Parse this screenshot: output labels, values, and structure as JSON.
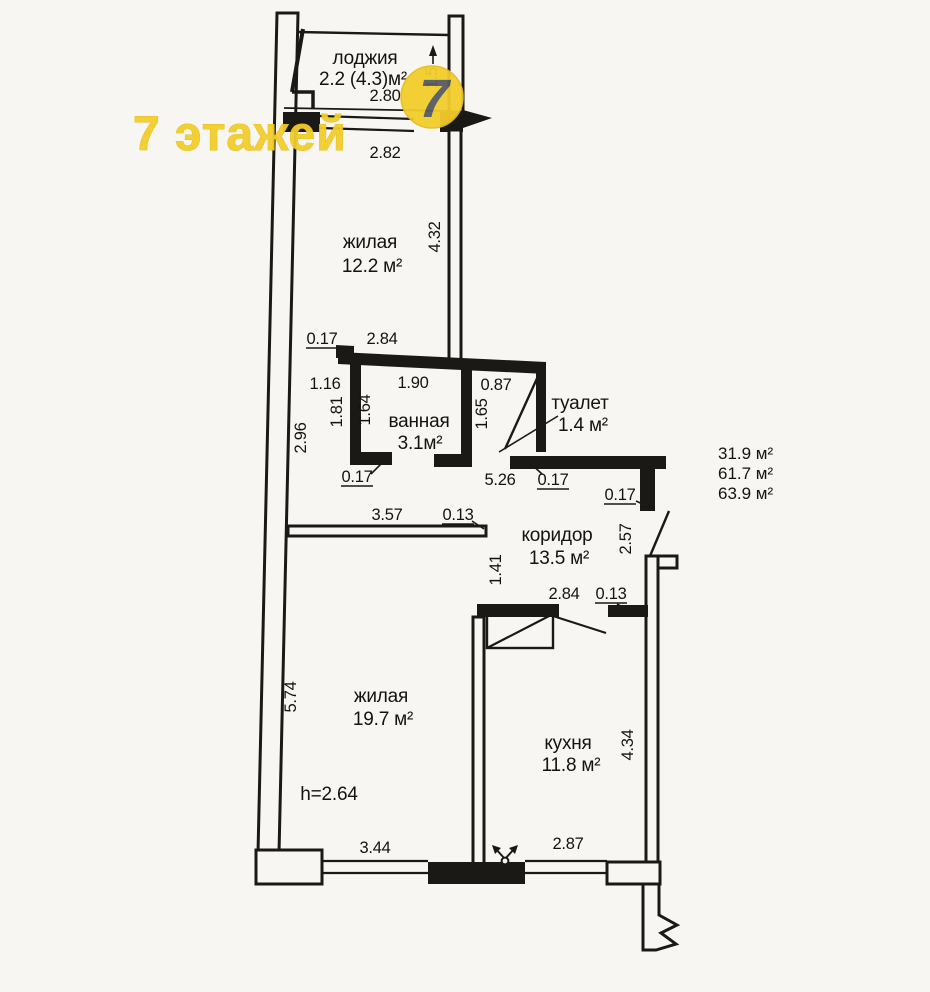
{
  "colors": {
    "paper": "#f8f6f2",
    "ink": "#1b1916",
    "watermark_yellow": "#f2cd2b",
    "logo_digit_gray": "#565b62"
  },
  "watermark": {
    "text": "7 этажей",
    "logo_digit": "7"
  },
  "rooms": {
    "loggia": {
      "name": "лоджия",
      "area": "2.2 (4.3)м²"
    },
    "living1": {
      "name": "жилая",
      "area": "12.2 м²"
    },
    "bathroom": {
      "name": "ванная",
      "area": "3.1м²"
    },
    "toilet": {
      "name": "туалет",
      "area": "1.4 м²"
    },
    "corridor": {
      "name": "коридор",
      "area": "13.5 м²"
    },
    "living2": {
      "name": "жилая",
      "area": "19.7 м²"
    },
    "kitchen": {
      "name": "кухня",
      "area": "11.8 м²"
    }
  },
  "totals": {
    "living_area": "31.9 м²",
    "floor_area": "61.7 м²",
    "total_area": "63.9 м²"
  },
  "ceiling_height": "h=2.64",
  "dims": {
    "loggia_width_top": "2.80",
    "loggia_width_bottom": "2.82",
    "loggia_depth": "1.5",
    "living1_height": "4.32",
    "living1_door_offset": "0.17",
    "living1_width": "2.84",
    "hall_width": "1.16",
    "bath_width": "1.90",
    "wc_width": "0.87",
    "hall_left_height": "1.81",
    "bath_depth": "1.64",
    "wc_depth": "1.65",
    "hall_height": "2.96",
    "bath_wall": "0.17",
    "wet_zone_width": "5.26",
    "wc_wall": "0.17",
    "corridor_jog": "0.17",
    "corridor_wall": "3.57",
    "corridor_wall_gap": "0.13",
    "passage_height": "1.41",
    "entry_height": "2.57",
    "kitchen_top_width": "2.84",
    "kitchen_top_gap": "0.13",
    "living2_height": "5.74",
    "living2_width": "3.44",
    "kitchen_width": "2.87",
    "kitchen_height": "4.34"
  }
}
